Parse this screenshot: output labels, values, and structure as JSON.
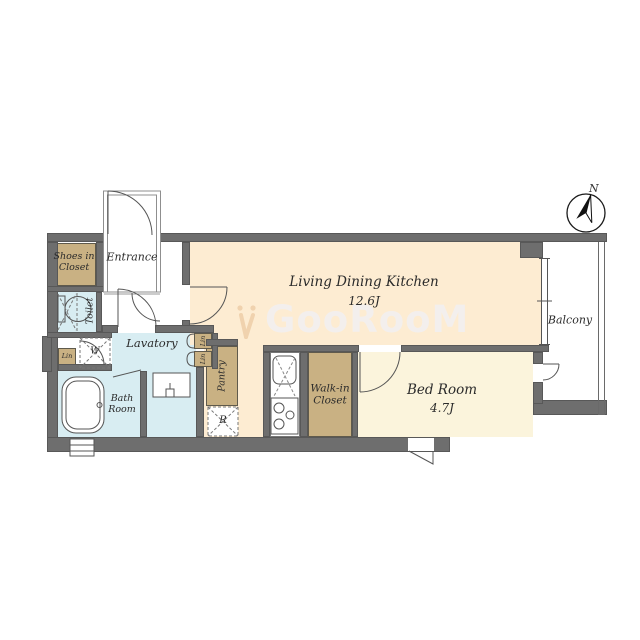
{
  "compass": {
    "north_label": "N"
  },
  "watermark": {
    "text": "GooRooM"
  },
  "rooms": {
    "living_dining_kitchen": {
      "label": "Living Dining Kitchen",
      "size": "12.6J"
    },
    "bed_room": {
      "label": "Bed Room",
      "size": "4.7J"
    },
    "balcony": {
      "label": "Balcony"
    },
    "entrance": {
      "label": "Entrance"
    },
    "shoes_in_closet": {
      "label": "Shoes in Closet"
    },
    "toilet": {
      "label": "Toilet"
    },
    "lavatory": {
      "label": "Lavatory"
    },
    "bath_room": {
      "label": "Bath Room"
    },
    "pantry": {
      "label": "Pantry"
    },
    "walk_in_closet": {
      "label": "Walk-in Closet"
    },
    "linen_left": {
      "label": "Lin"
    },
    "linen_upper": {
      "label": "Lin"
    },
    "linen_lower": {
      "label": "Lin"
    },
    "washing_machine": {
      "label": "W"
    },
    "refrigerator": {
      "label": "R"
    }
  },
  "colors": {
    "wall": "#6e6e6e",
    "ldk_floor": "#fdecd2",
    "bedroom_floor": "#fbf4dc",
    "closet": "#c9b183",
    "wet_area": "#d8edf2",
    "line": "#555555"
  }
}
